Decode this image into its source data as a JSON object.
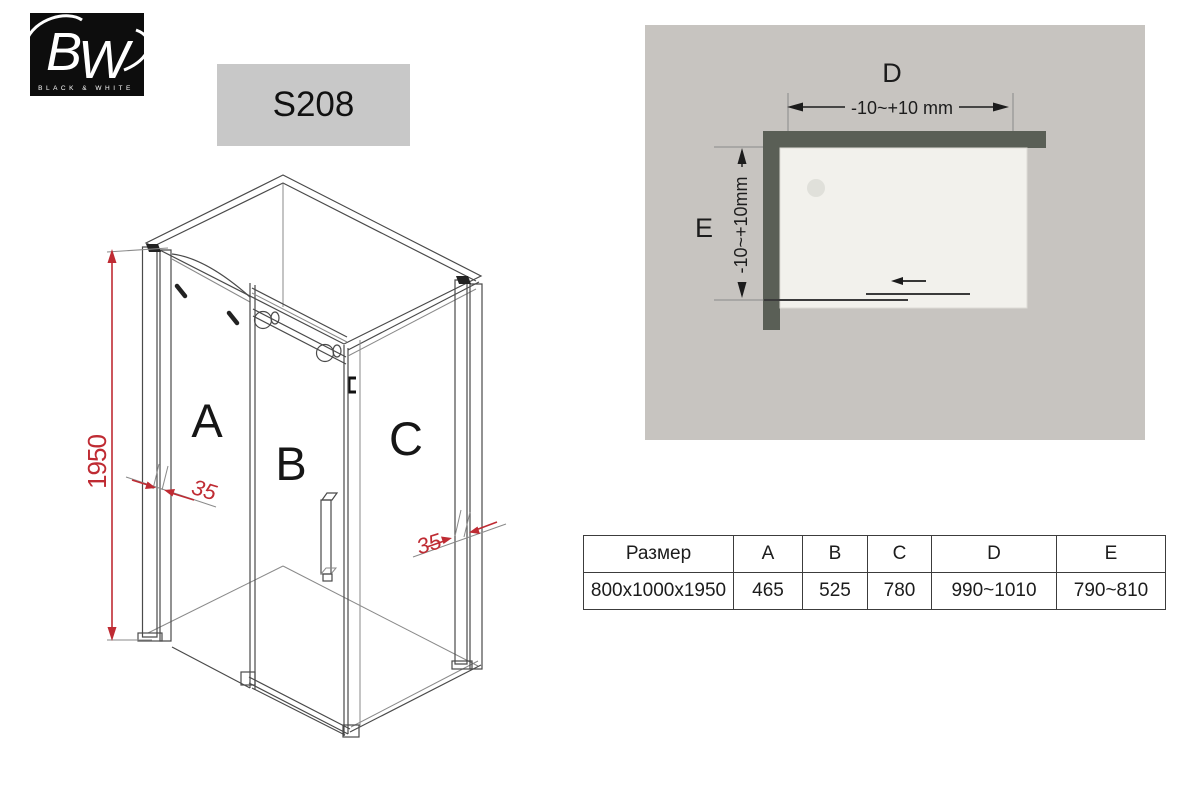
{
  "logo": {
    "initials": "BW",
    "caption": "BLACK & WHITE"
  },
  "badge": {
    "model": "S208"
  },
  "iso_diagram": {
    "panel_labels": {
      "a": "A",
      "b": "B",
      "c": "C"
    },
    "height_dim": "1950",
    "wall_adjust_left": "35",
    "wall_adjust_right": "35"
  },
  "top_view": {
    "width_label": "D",
    "width_tolerance": "-10~+10 mm",
    "depth_label": "E",
    "depth_tolerance": "-10~+10mm"
  },
  "spec_table": {
    "headers": [
      "Размер",
      "A",
      "B",
      "C",
      "D",
      "E"
    ],
    "rows": [
      [
        "800x1000x1950",
        "465",
        "525",
        "780",
        "990~1010",
        "790~810"
      ]
    ]
  },
  "colors": {
    "accent_red": "#bf2b33",
    "wall_gray": "#5a5f56",
    "panel_gray": "#c7c4c0",
    "tray_white": "#f2f1ec",
    "badge_gray": "#c8c8c8",
    "line_dark": "#4a4a4a"
  }
}
